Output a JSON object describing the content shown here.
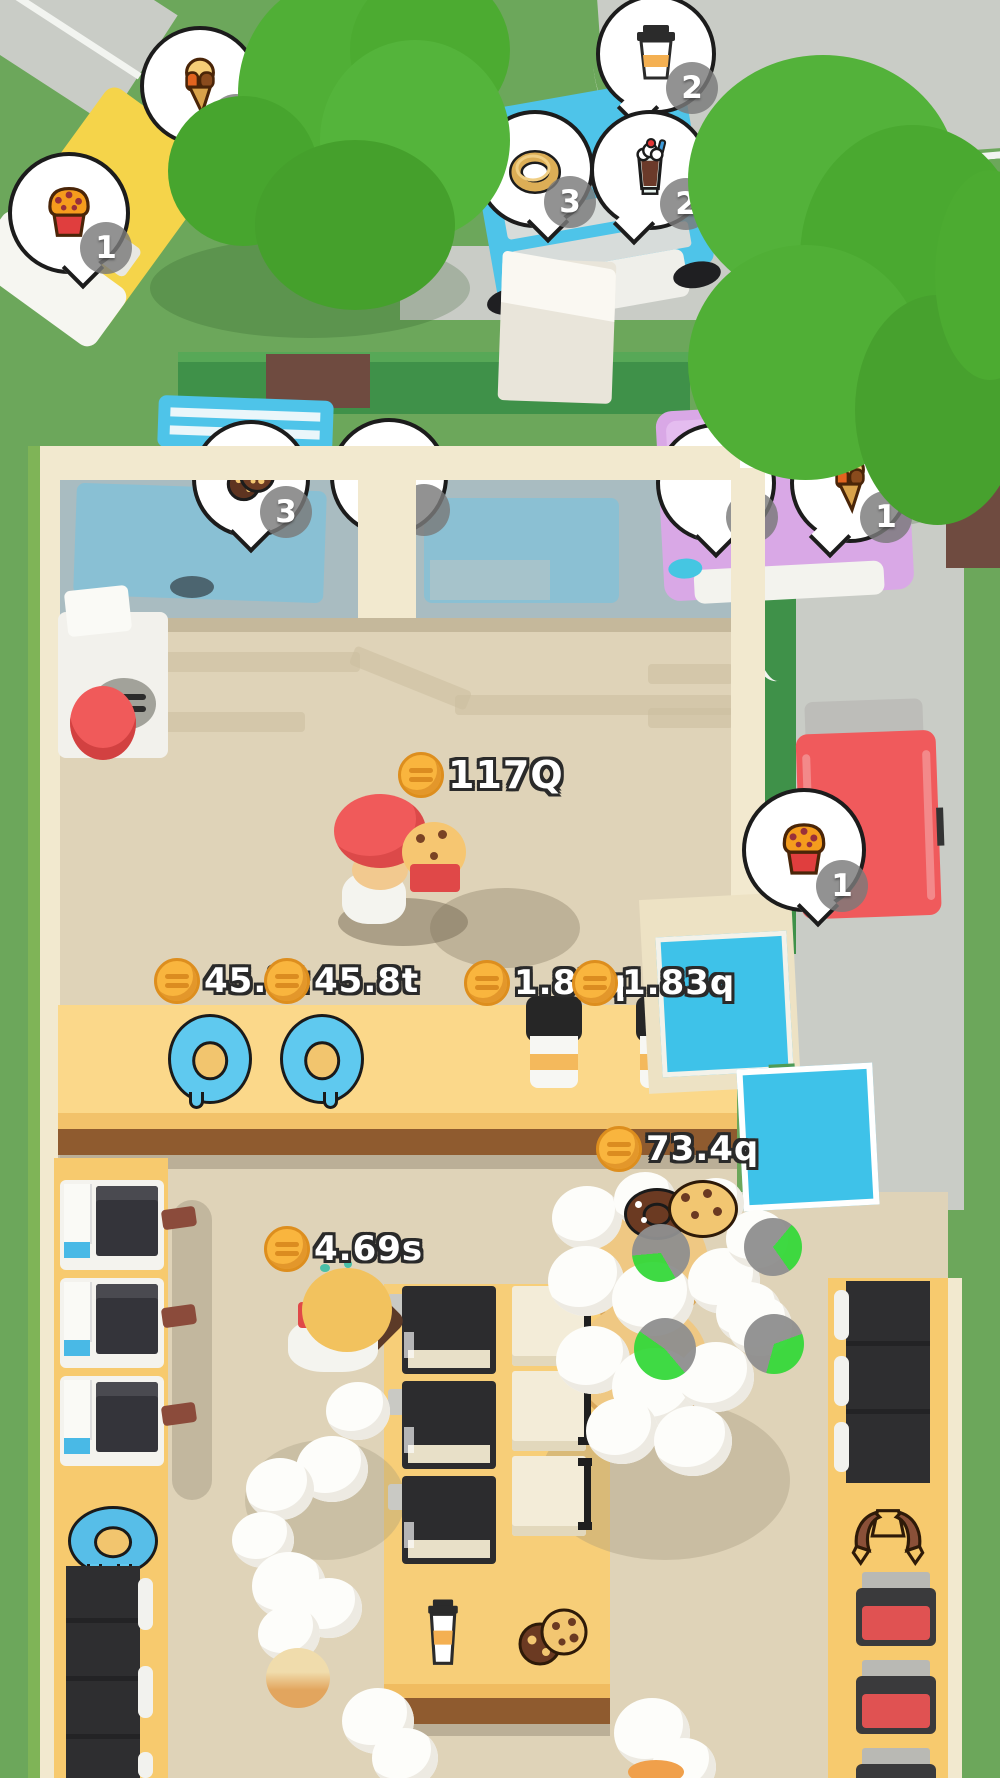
{
  "meta": {
    "scene": "bakery-drive-thru-idle-game-overview"
  },
  "colors": {
    "grass": "#6CA75B",
    "road": "#C9CCC6",
    "tree_green": "#53B23A",
    "floor": "#DFD3B8",
    "wall_cream": "#F2E9CF",
    "counter_top": "#FBD88A",
    "counter_front": "#8F5B2F",
    "glass_cyan": "#3EC2E9",
    "coin_gold": "#F9B53E",
    "timer_green": "#35D83A",
    "car_yellow": "#F5D44A",
    "truck_blue": "#4EC4E9",
    "car_purple": "#D9A8E6",
    "car_red": "#F05A5C"
  },
  "hud": {
    "money_labels": [
      {
        "id": "kitchen-center",
        "text": "117Q"
      },
      {
        "id": "donut-left",
        "text": "45.8t"
      },
      {
        "id": "donut-right",
        "text": "45.8t"
      },
      {
        "id": "coffee-left",
        "text": "1.83q"
      },
      {
        "id": "coffee-right",
        "text": "1.83q"
      },
      {
        "id": "counter-front",
        "text": "73.4q"
      },
      {
        "id": "lobby",
        "text": "4.69s"
      }
    ]
  },
  "orders": {
    "bubbles": [
      {
        "vehicle": "yellow-car",
        "item": "ice-cream-cone",
        "count": "1"
      },
      {
        "vehicle": "yellow-car",
        "item": "muffin",
        "count": "1"
      },
      {
        "vehicle": "blue-truck",
        "item": "coffee-cup",
        "count": "2"
      },
      {
        "vehicle": "blue-truck",
        "item": "donut",
        "count": "3"
      },
      {
        "vehicle": "blue-truck",
        "item": "milkshake",
        "count": "2"
      },
      {
        "vehicle": "purple-car",
        "item": "donut-blue",
        "count": ""
      },
      {
        "vehicle": "purple-car",
        "item": "hidden",
        "count": ""
      },
      {
        "vehicle": "purple-car",
        "item": "ice-cream-cone",
        "count": "1"
      },
      {
        "vehicle": "window-car",
        "item": "cookie",
        "count": "3"
      },
      {
        "vehicle": "window-car",
        "item": "hidden",
        "count": ""
      },
      {
        "vehicle": "red-car",
        "item": "muffin",
        "count": "1"
      }
    ]
  },
  "tables": {
    "eating_timers": [
      {
        "progress": 0.32
      },
      {
        "progress": 0.29
      },
      {
        "progress": 0.46
      },
      {
        "progress": 0.35
      }
    ]
  },
  "icons": {
    "muffin-icon": "orange muffin in red cup",
    "ice-cream-icon": "cone with caramel drips",
    "coffee-icon": "takeaway cup with lid",
    "donut-icon": "golden donut ring",
    "milkshake-icon": "glass with cream, cherry and straw",
    "donut-blue-icon": "blue-iced donut",
    "cookie-icon": "chocolate chip cookies",
    "croissant-icon": "croissant",
    "coin-icon": "gold coin with burger lines"
  }
}
